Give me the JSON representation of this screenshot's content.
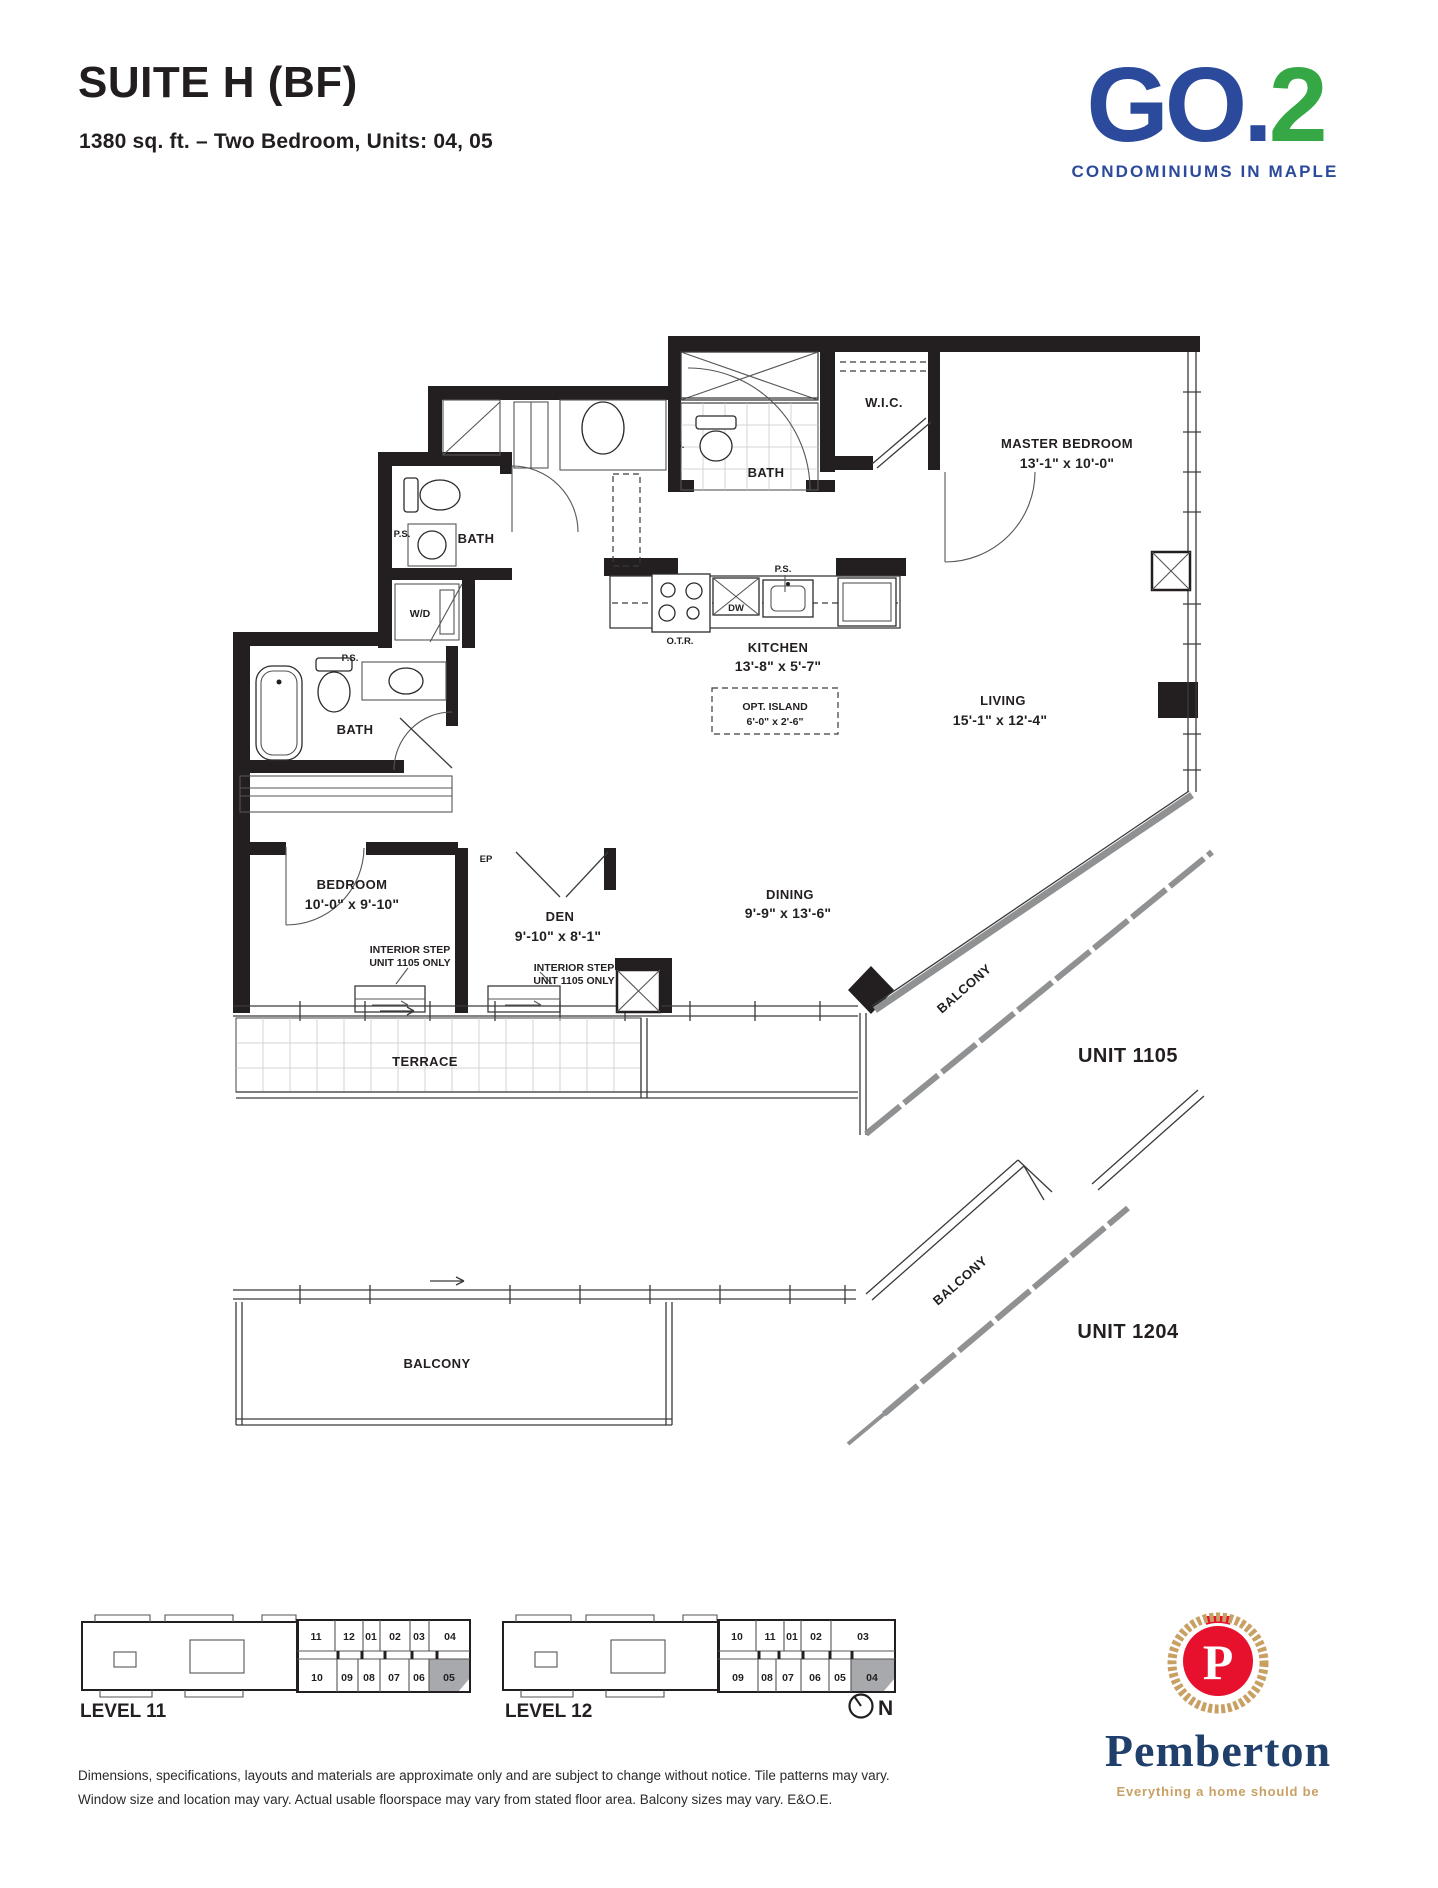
{
  "header": {
    "suite_title": "SUITE H (BF)",
    "suite_subtitle": "1380 sq. ft. – Two Bedroom, Units: 04, 05"
  },
  "brand": {
    "logo_go": "GO.",
    "logo_2": "2",
    "tagline": "CONDOMINIUMS IN MAPLE"
  },
  "colors": {
    "brand_blue": "#2B4A9B",
    "brand_green": "#35A845",
    "pemberton_navy": "#20406B",
    "pemberton_red": "#E8112D",
    "pemberton_gold": "#C9A063",
    "highlight_gray": "#A7A9AC"
  },
  "plan": {
    "rooms": {
      "master_bedroom": {
        "name": "MASTER BEDROOM",
        "dims": "13'-1\" x 10'-0\""
      },
      "wic": {
        "name": "W.I.C."
      },
      "master_bath": {
        "name": "BATH"
      },
      "kitchen": {
        "name": "KITCHEN",
        "dims": "13'-8\" x 5'-7\""
      },
      "island": {
        "name": "OPT. ISLAND",
        "dims": "6'-0\" x 2'-6\""
      },
      "living": {
        "name": "LIVING",
        "dims": "15'-1\" x 12'-4\""
      },
      "dining": {
        "name": "DINING",
        "dims": "9'-9\" x 13'-6\""
      },
      "den": {
        "name": "DEN",
        "dims": "9'-10\" x 8'-1\""
      },
      "bedroom": {
        "name": "BEDROOM",
        "dims": "10'-0\" x 9'-10\""
      },
      "bath2": {
        "name": "BATH"
      },
      "bath3": {
        "name": "BATH"
      },
      "wd": {
        "name": "W/D"
      },
      "terrace": {
        "name": "TERRACE"
      },
      "balcony": {
        "name": "BALCONY"
      }
    },
    "annotations": {
      "ps": "P.S.",
      "otr": "O.T.R.",
      "dw": "DW",
      "ep": "EP",
      "step_line1": "INTERIOR STEP",
      "step_line2": "UNIT 1105 ONLY",
      "unit_1105": "UNIT 1105",
      "unit_1204": "UNIT 1204"
    }
  },
  "keyplans": {
    "level11": {
      "label": "LEVEL 11",
      "top": [
        "11",
        "12",
        "01",
        "02",
        "03",
        "04"
      ],
      "bottom": [
        "10",
        "09",
        "08",
        "07",
        "06",
        "05"
      ],
      "highlighted": "05"
    },
    "level12": {
      "label": "LEVEL 12",
      "top": [
        "10",
        "11",
        "01",
        "02",
        "03"
      ],
      "bottom": [
        "09",
        "08",
        "07",
        "06",
        "05",
        "04"
      ],
      "highlighted": "04"
    },
    "compass": "N"
  },
  "developer": {
    "monogram": "P",
    "name": "Pemberton",
    "tagline": "Everything a home should be"
  },
  "footer": {
    "line1": "Dimensions, specifications, layouts and materials are approximate only and are subject to change without notice. Tile patterns may vary.",
    "line2": "Window size and location may vary. Actual usable floorspace may vary from stated floor area. Balcony sizes may vary. E&O.E."
  }
}
